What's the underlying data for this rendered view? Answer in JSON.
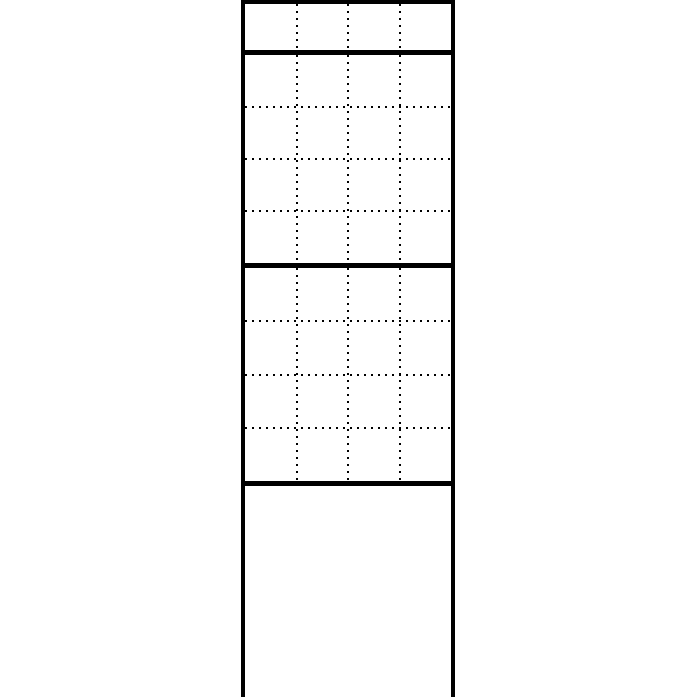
{
  "figure": {
    "type": "technical-line-drawing",
    "description": "Tall free-standing modular panel post: one narrow top module row, two stacked 4x4 module grids with dotted division lines, and an open-bottom post base formed by two side rails",
    "background_color": "#ffffff",
    "line_color": "#000000",
    "sections": [
      {
        "id": "top-module-row",
        "columns": 4,
        "rows": 1,
        "grid_style": "dotted",
        "outline": "solid-closed"
      },
      {
        "id": "upper-module-grid",
        "columns": 4,
        "rows": 4,
        "grid_style": "dotted",
        "outline": "solid-closed"
      },
      {
        "id": "lower-module-grid",
        "columns": 4,
        "rows": 4,
        "grid_style": "dotted",
        "outline": "solid-closed"
      },
      {
        "id": "post-base",
        "columns": 1,
        "rows": 1,
        "grid_style": "none",
        "outline": "side-rails-open-bottom"
      }
    ]
  }
}
